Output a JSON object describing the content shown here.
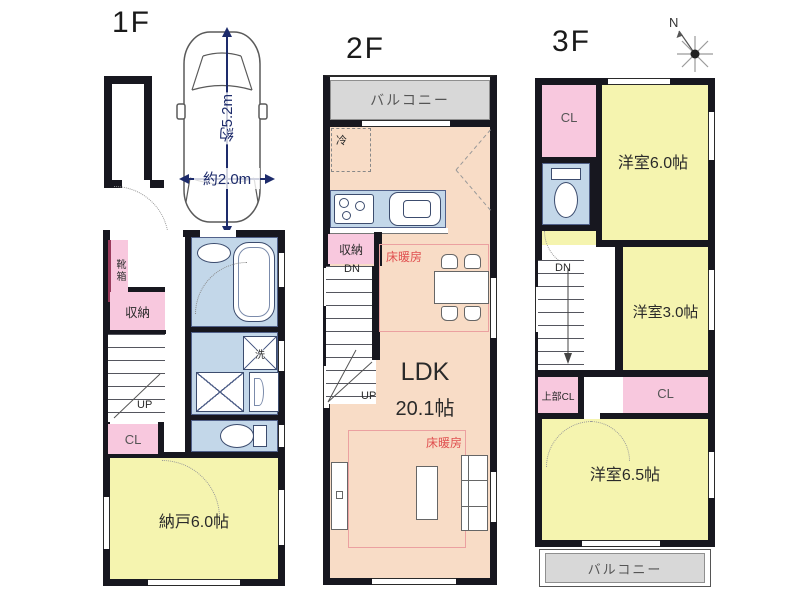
{
  "palette": {
    "wall": "#17171f",
    "room_yellow": "#f5f4af",
    "closet_pink": "#f8c8de",
    "wet_area_blue": "#c3d7e9",
    "ldk_peach": "#f8dcc6",
    "balcony_gray": "#d8d8d8",
    "floor_heating_red": "#e05050",
    "dimension_navy": "#1d2b6b"
  },
  "floor1": {
    "title": "1F",
    "dim_depth": "約5.2m",
    "dim_width": "約2.0m",
    "shoe_cabinet": "靴箱",
    "storage": "収納",
    "up": "UP",
    "closet": "CL",
    "storeroom": "納戸6.0帖",
    "washer": "洗"
  },
  "floor2": {
    "title": "2F",
    "balcony": "バルコニー",
    "fridge": "冷",
    "storage": "収納",
    "down": "DN",
    "up": "UP",
    "floor_heating": "床暖房",
    "ldk": "LDK",
    "ldk_size": "20.1帖"
  },
  "floor3": {
    "title": "3F",
    "compass_north": "N",
    "closet_top": "CL",
    "room_6_0": "洋室6.0帖",
    "down": "DN",
    "room_3_0": "洋室3.0帖",
    "upper_closet": "上部CL",
    "closet_mid": "CL",
    "room_6_5": "洋室6.5帖",
    "balcony": "バルコニー"
  }
}
